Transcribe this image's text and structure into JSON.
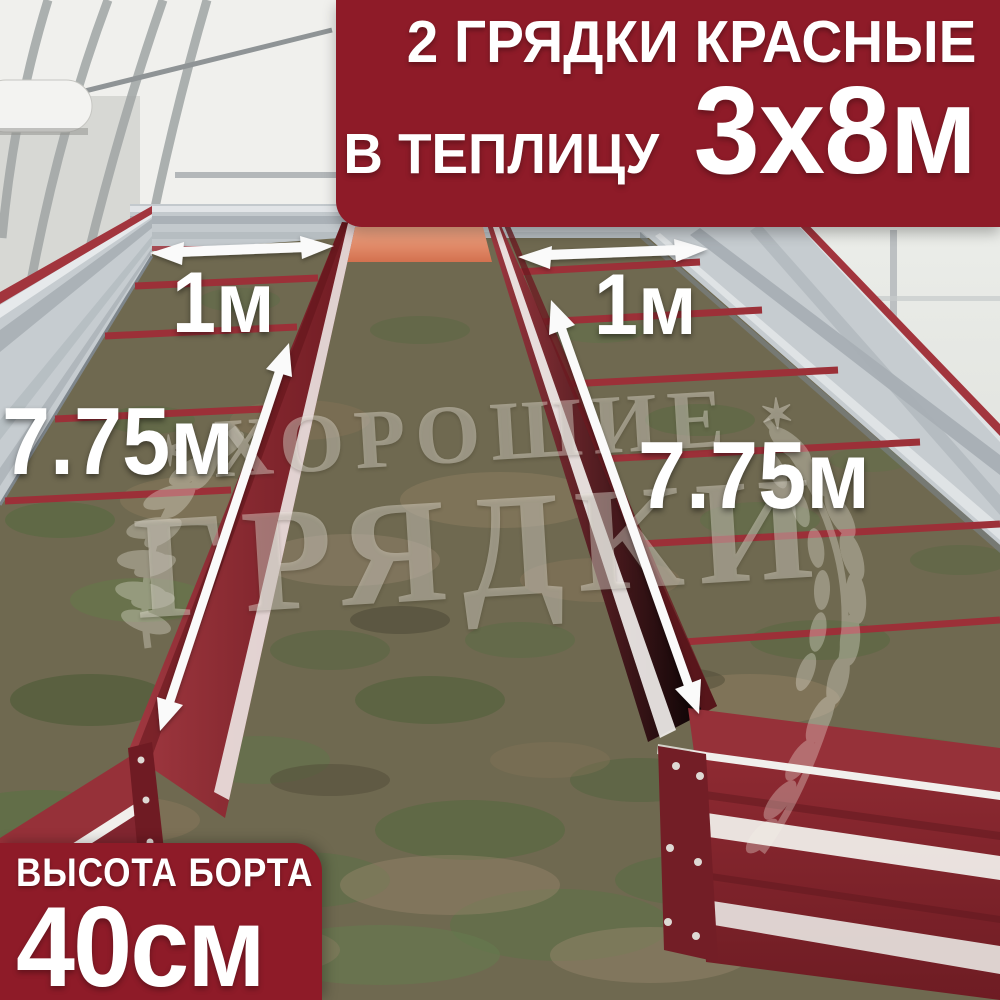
{
  "product_banner": {
    "line1": "2 ГРЯДКИ КРАСНЫЕ",
    "line2_label": "В ТЕПЛИЦУ",
    "line2_size": "3х8м"
  },
  "height_banner": {
    "label": "ВЫСОТА БОРТА",
    "value": "40см"
  },
  "measurements": {
    "bed_width_left": "1м",
    "bed_width_right": "1м",
    "bed_length_left": "7.75м",
    "bed_length_right": "7.75м"
  },
  "watermark": {
    "word1": "ХОРОШИЕ",
    "word2": "ГРЯДКИ",
    "star": "✶"
  },
  "icons": {
    "arrows": "white-double-headed-measurement-arrows",
    "laurel": "laurel-branch-watermark"
  },
  "colors": {
    "banner_red": "#8e1b28",
    "bed_red": "#8e2a32",
    "bed_end_orange": "#e08a66",
    "galvanized_silver": "#c6ccd0",
    "ground_base": "#6f6950",
    "arrow_white": "#fafafa",
    "text_white": "#ffffff",
    "watermark_tint": "rgba(242,238,228,0.4)"
  }
}
